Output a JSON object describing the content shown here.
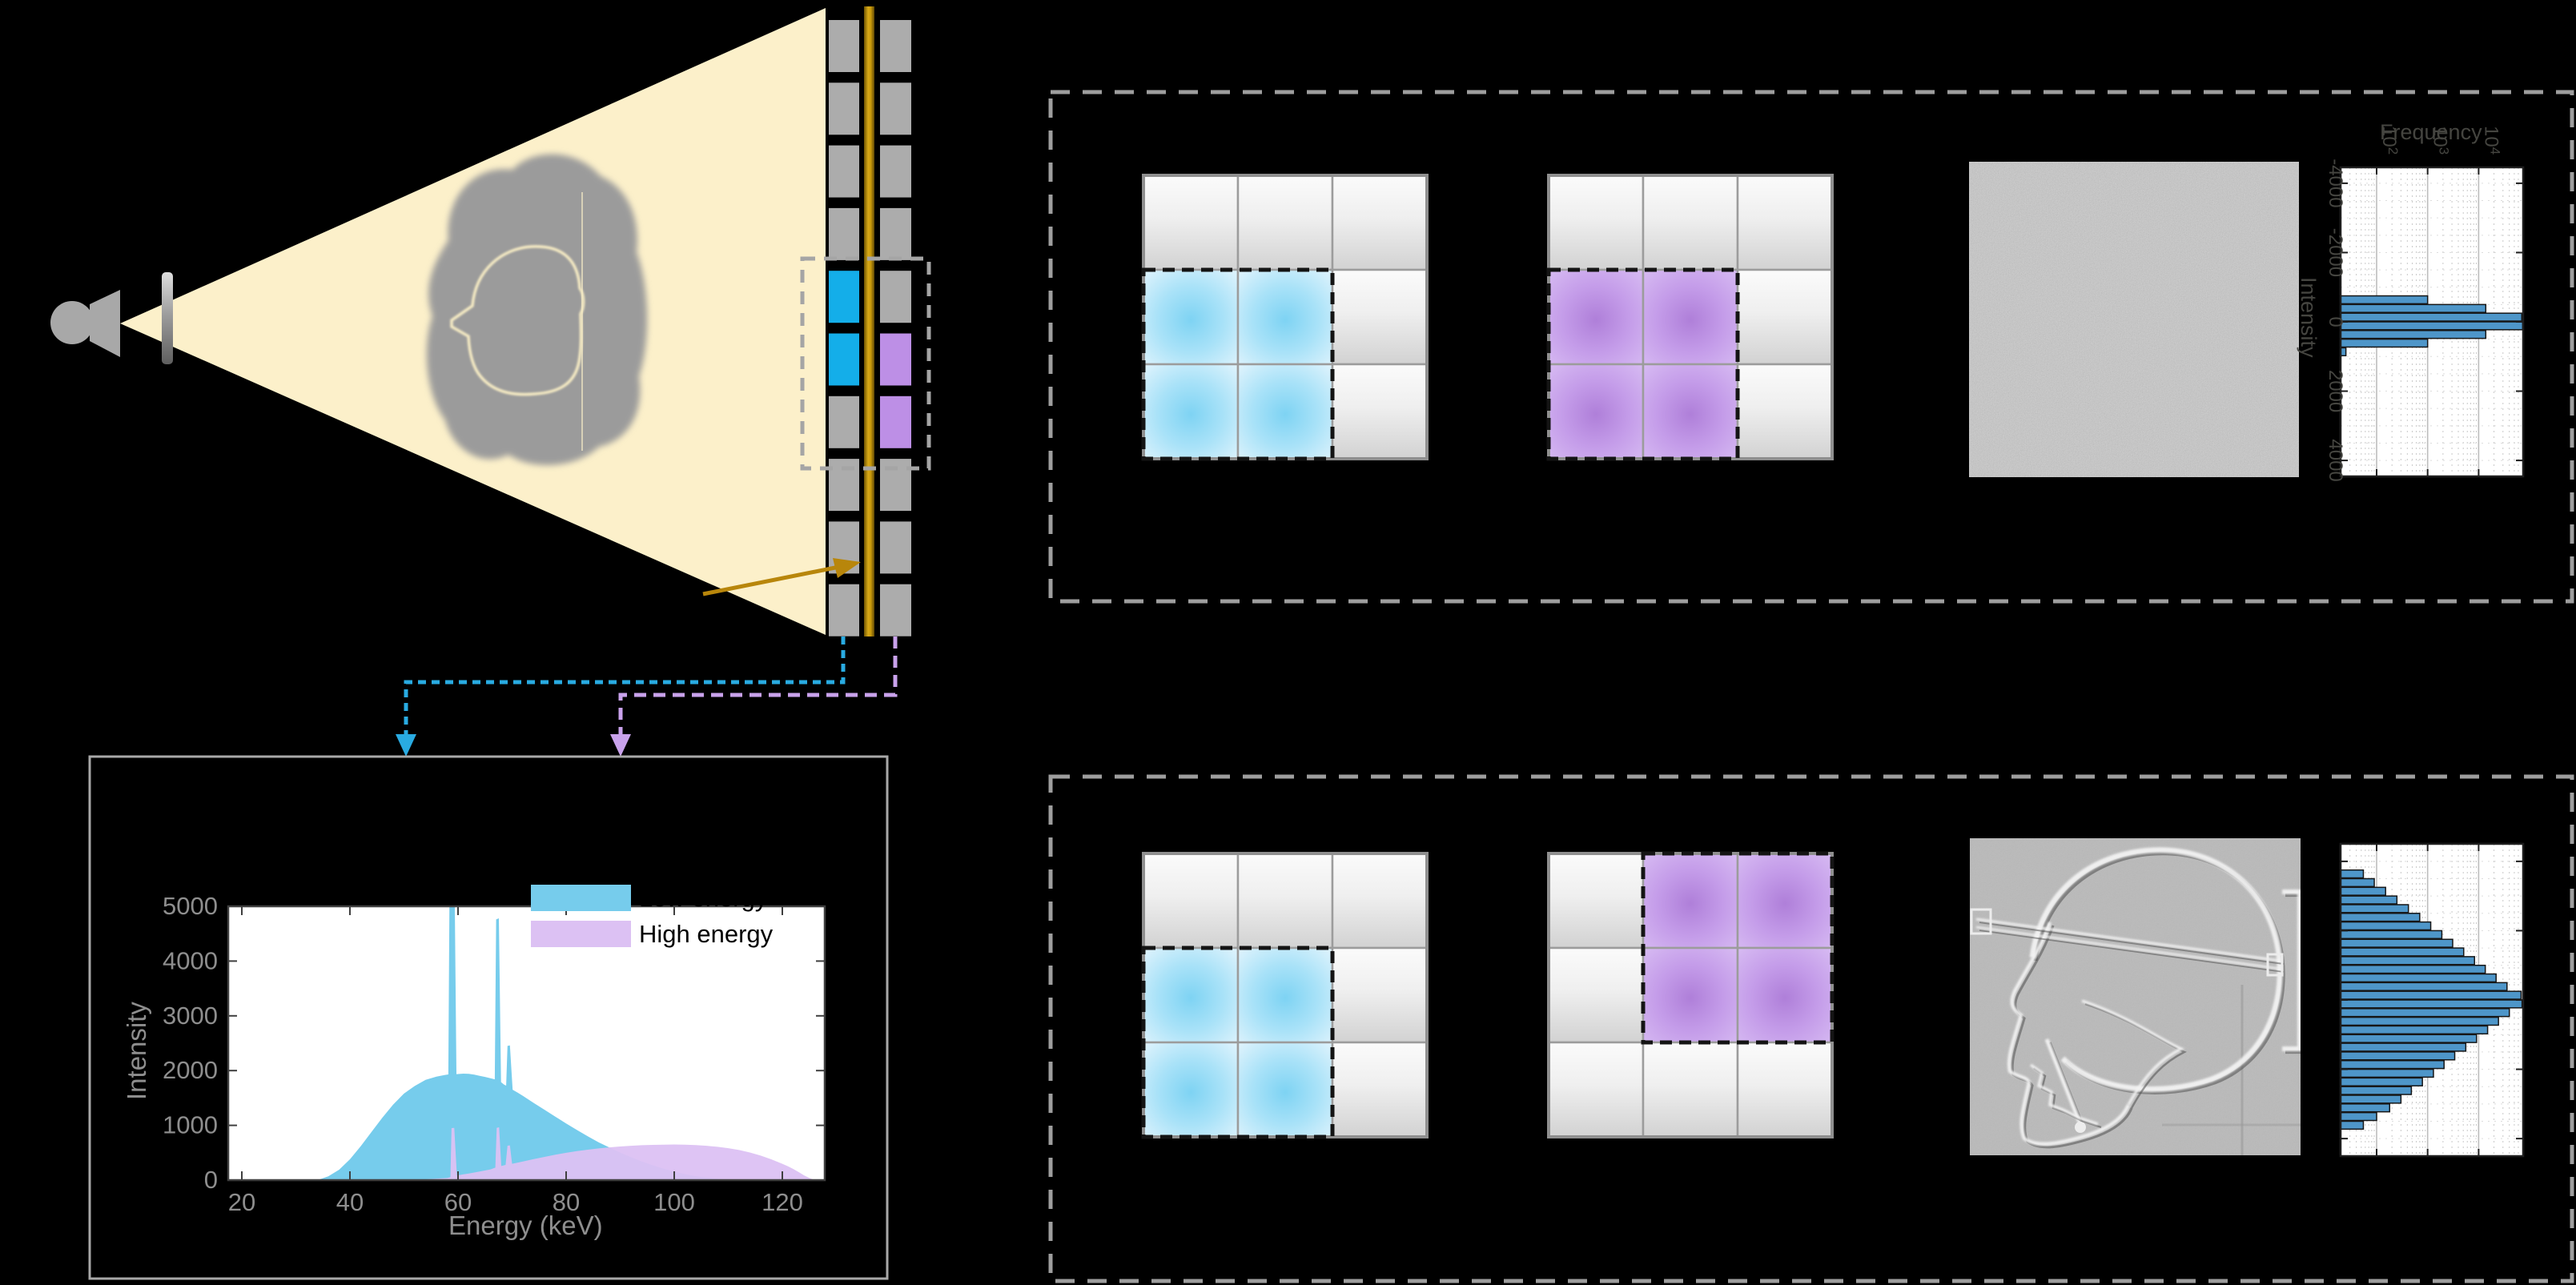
{
  "figure": {
    "background": "#000000",
    "beam_color": "#FCF0CA",
    "gold_color": "#C9990B",
    "gold_dark": "#6E5403",
    "metal_gray": "#A8A8A8",
    "phantom_gray": "#9B9B9B",
    "phantom_outline_color": "#F7ECC4",
    "dashed_box_color": "#9E9E9E",
    "panel_border_color": "#A8A8A8"
  },
  "apparatus": {
    "source_name": "x-ray-source",
    "filter_name": "beam-filter",
    "detector": {
      "rows": 10,
      "pixel_color": "#ACACAC",
      "low_energy_color": "#14AEE9",
      "high_energy_color": "#BD8FE6",
      "low_rows": [
        4,
        5
      ],
      "high_rows": [
        5,
        6
      ],
      "scintillator_color": "#C9990B"
    },
    "connector_low_color": "#29ABE2",
    "connector_high_color": "#C9A2EC"
  },
  "panels": {
    "top": {
      "left_grid": {
        "highlight": "low",
        "block_row": 1,
        "block_col": 0
      },
      "right_grid": {
        "highlight": "high",
        "block_row": 1,
        "block_col": 0
      },
      "image_type": "uniform-noise"
    },
    "bottom": {
      "left_grid": {
        "highlight": "low",
        "block_row": 1,
        "block_col": 0
      },
      "right_grid": {
        "highlight": "high",
        "block_row": 0,
        "block_col": 1
      },
      "image_type": "skull-radiograph"
    },
    "cell_colors": {
      "gray_top": "#FBFBFB",
      "gray_bottom": "#D2D2D2",
      "blue_center": "#7ED3F3",
      "blue_edge": "#E9F8FE",
      "purple_center": "#AF7FD9",
      "purple_edge": "#DCC3F4",
      "grid_line": "#9C9C9C",
      "highlight_dash": "#141414"
    }
  },
  "chart_data": [
    {
      "id": "spectrum",
      "type": "area",
      "title": "",
      "xlabel": "Energy (keV)",
      "ylabel": "Intensity",
      "xlim": [
        17.5,
        127.8
      ],
      "ylim": [
        0,
        5000
      ],
      "xticks": [
        20,
        40,
        60,
        80,
        100,
        120
      ],
      "yticks": [
        0,
        1000,
        2000,
        3000,
        4000,
        5000
      ],
      "grid": false,
      "legend_position": "upper right",
      "legend": [
        "Low energy",
        "High energy"
      ],
      "series": [
        {
          "name": "Low energy",
          "color": "#76CCEC",
          "points": [
            [
              34,
              0
            ],
            [
              36,
              70
            ],
            [
              38,
              190
            ],
            [
              40,
              380
            ],
            [
              42,
              620
            ],
            [
              44,
              880
            ],
            [
              46,
              1140
            ],
            [
              48,
              1380
            ],
            [
              50,
              1580
            ],
            [
              52,
              1720
            ],
            [
              54,
              1830
            ],
            [
              56,
              1890
            ],
            [
              57.5,
              1920
            ],
            [
              58.2,
              1930
            ],
            [
              58.45,
              5600
            ],
            [
              59.35,
              5600
            ],
            [
              59.7,
              1935
            ],
            [
              61,
              1945
            ],
            [
              62,
              1940
            ],
            [
              63,
              1925
            ],
            [
              64,
              1905
            ],
            [
              65,
              1885
            ],
            [
              66,
              1860
            ],
            [
              66.8,
              1840
            ],
            [
              67.05,
              4760
            ],
            [
              67.55,
              4780
            ],
            [
              67.95,
              1790
            ],
            [
              68.5,
              1745
            ],
            [
              68.9,
              1725
            ],
            [
              69.15,
              2450
            ],
            [
              69.6,
              2460
            ],
            [
              70.1,
              1650
            ],
            [
              71,
              1600
            ],
            [
              72,
              1540
            ],
            [
              74,
              1410
            ],
            [
              76,
              1285
            ],
            [
              78,
              1160
            ],
            [
              80,
              1035
            ],
            [
              82,
              915
            ],
            [
              84,
              800
            ],
            [
              86,
              692
            ],
            [
              88,
              595
            ],
            [
              90,
              503
            ],
            [
              92,
              418
            ],
            [
              94,
              342
            ],
            [
              96,
              272
            ],
            [
              98,
              210
            ],
            [
              100,
              156
            ],
            [
              102,
              110
            ],
            [
              104,
              72
            ],
            [
              106,
              45
            ],
            [
              108,
              25
            ],
            [
              110,
              12
            ],
            [
              112,
              4
            ],
            [
              114,
              0
            ]
          ]
        },
        {
          "name": "High energy",
          "color": "#DCC1F3",
          "points": [
            [
              50,
              0
            ],
            [
              54,
              14
            ],
            [
              58,
              38
            ],
            [
              58.6,
              55
            ],
            [
              58.8,
              950
            ],
            [
              59.3,
              955
            ],
            [
              59.8,
              85
            ],
            [
              61,
              105
            ],
            [
              62,
              122
            ],
            [
              64,
              158
            ],
            [
              66,
              196
            ],
            [
              66.9,
              228
            ],
            [
              67.15,
              955
            ],
            [
              67.6,
              965
            ],
            [
              68.0,
              258
            ],
            [
              68.8,
              278
            ],
            [
              69.15,
              628
            ],
            [
              69.6,
              635
            ],
            [
              70.0,
              298
            ],
            [
              72,
              340
            ],
            [
              74,
              384
            ],
            [
              76,
              424
            ],
            [
              78,
              463
            ],
            [
              80,
              498
            ],
            [
              82,
              529
            ],
            [
              84,
              556
            ],
            [
              86,
              579
            ],
            [
              88,
              598
            ],
            [
              90,
              614
            ],
            [
              92,
              627
            ],
            [
              94,
              637
            ],
            [
              96,
              644
            ],
            [
              98,
              648
            ],
            [
              100,
              650
            ],
            [
              102,
              647
            ],
            [
              104,
              640
            ],
            [
              106,
              627
            ],
            [
              108,
              608
            ],
            [
              110,
              583
            ],
            [
              112,
              549
            ],
            [
              114,
              504
            ],
            [
              116,
              448
            ],
            [
              118,
              378
            ],
            [
              120,
              298
            ],
            [
              121,
              254
            ],
            [
              122,
              204
            ],
            [
              123,
              148
            ],
            [
              124,
              88
            ],
            [
              125,
              38
            ],
            [
              126,
              0
            ]
          ]
        }
      ]
    },
    {
      "id": "hist_registered",
      "type": "bar",
      "orientation": "rotated-90cw",
      "freq_label": "Frequency",
      "intensity_label": "Intensity",
      "value_scale": "log",
      "freq_ticks": [
        {
          "v": 100,
          "e": "2"
        },
        {
          "v": 1000,
          "e": "3"
        },
        {
          "v": 10000,
          "e": "4"
        }
      ],
      "intensity_ticks": [
        -4000,
        -2000,
        0,
        2000,
        4000
      ],
      "intensity_range": [
        -4460,
        4460
      ],
      "freq_range_log": [
        1.294,
        4.88
      ],
      "bin_width": 250,
      "bar_color": "#4E96C9",
      "bar_edge": "#161616",
      "labels_visible": true,
      "bars": [
        {
          "center": -625,
          "freq": 1000
        },
        {
          "center": -375,
          "freq": 13800
        },
        {
          "center": -125,
          "freq": 70000
        },
        {
          "center": 125,
          "freq": 73000
        },
        {
          "center": 375,
          "freq": 13800
        },
        {
          "center": 625,
          "freq": 1000
        },
        {
          "center": 875,
          "freq": 25
        }
      ]
    },
    {
      "id": "hist_unregistered",
      "type": "bar",
      "orientation": "rotated-90cw",
      "freq_label": "",
      "intensity_label": "",
      "value_scale": "log",
      "freq_ticks": [
        {
          "v": 100,
          "e": "2"
        },
        {
          "v": 1000,
          "e": "3"
        },
        {
          "v": 10000,
          "e": "4"
        }
      ],
      "intensity_ticks": [],
      "intensity_range": [
        -4505,
        4505
      ],
      "freq_range_log": [
        1.294,
        4.88
      ],
      "bin_width": 250,
      "bar_color": "#4E96C9",
      "bar_edge": "#161616",
      "labels_visible": false,
      "bars": [
        {
          "center": -3625,
          "freq": 55
        },
        {
          "center": -3375,
          "freq": 90
        },
        {
          "center": -3125,
          "freq": 150
        },
        {
          "center": -2875,
          "freq": 250
        },
        {
          "center": -2625,
          "freq": 420
        },
        {
          "center": -2375,
          "freq": 700
        },
        {
          "center": -2125,
          "freq": 1150
        },
        {
          "center": -1875,
          "freq": 1900
        },
        {
          "center": -1625,
          "freq": 3100
        },
        {
          "center": -1375,
          "freq": 5100
        },
        {
          "center": -1125,
          "freq": 8300
        },
        {
          "center": -875,
          "freq": 13500
        },
        {
          "center": -625,
          "freq": 22000
        },
        {
          "center": -375,
          "freq": 36000
        },
        {
          "center": -125,
          "freq": 68000
        },
        {
          "center": 125,
          "freq": 71000
        },
        {
          "center": 375,
          "freq": 40000
        },
        {
          "center": 625,
          "freq": 24500
        },
        {
          "center": 875,
          "freq": 15000
        },
        {
          "center": 1125,
          "freq": 9100
        },
        {
          "center": 1375,
          "freq": 5600
        },
        {
          "center": 1625,
          "freq": 3400
        },
        {
          "center": 1875,
          "freq": 2100
        },
        {
          "center": 2125,
          "freq": 1300
        },
        {
          "center": 2375,
          "freq": 790
        },
        {
          "center": 2625,
          "freq": 480
        },
        {
          "center": 2875,
          "freq": 300
        },
        {
          "center": 3125,
          "freq": 180
        },
        {
          "center": 3375,
          "freq": 100
        },
        {
          "center": 3625,
          "freq": 55
        }
      ]
    }
  ]
}
